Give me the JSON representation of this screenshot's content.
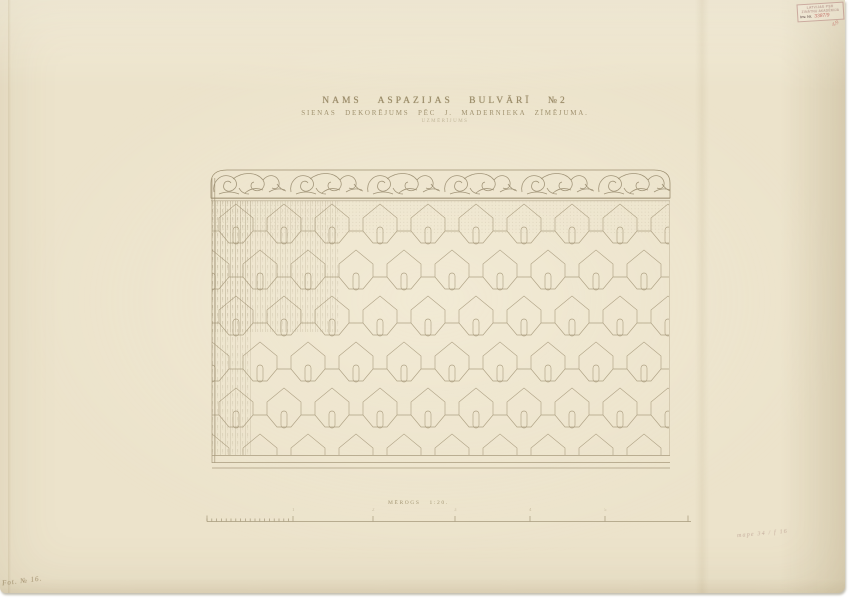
{
  "sheet": {
    "title": {
      "line1": "NAMS ASPAZIJAS BULVĀRĪ №2",
      "line2": "SIENAS DEKORĒJUMS PĒC J. MADERNIEKA ZĪMĒJUMA.",
      "line3": "UZMĒRĪJUMS"
    },
    "scale_bar": {
      "label": "MĒROGS",
      "ratio": "1:20.",
      "tick_numbers": [
        "1",
        "2",
        "3",
        "4",
        "5"
      ]
    },
    "stamp": {
      "line1": "LATVIJAS PSR",
      "line2": "ZINĀTŅU AKADĒMIJA",
      "inv_label": "Inv. Nr.",
      "inv_number": "3387/9",
      "corner_note": "4/9"
    },
    "handwriting": {
      "bottom_left": "Fot. № 16.",
      "bottom_right": "mape 34 / f 16"
    },
    "colors": {
      "paper": "#ece3cb",
      "ink": "#a69878",
      "title_ink": "#8d7d58",
      "stamp_red": "#c4756c"
    }
  }
}
